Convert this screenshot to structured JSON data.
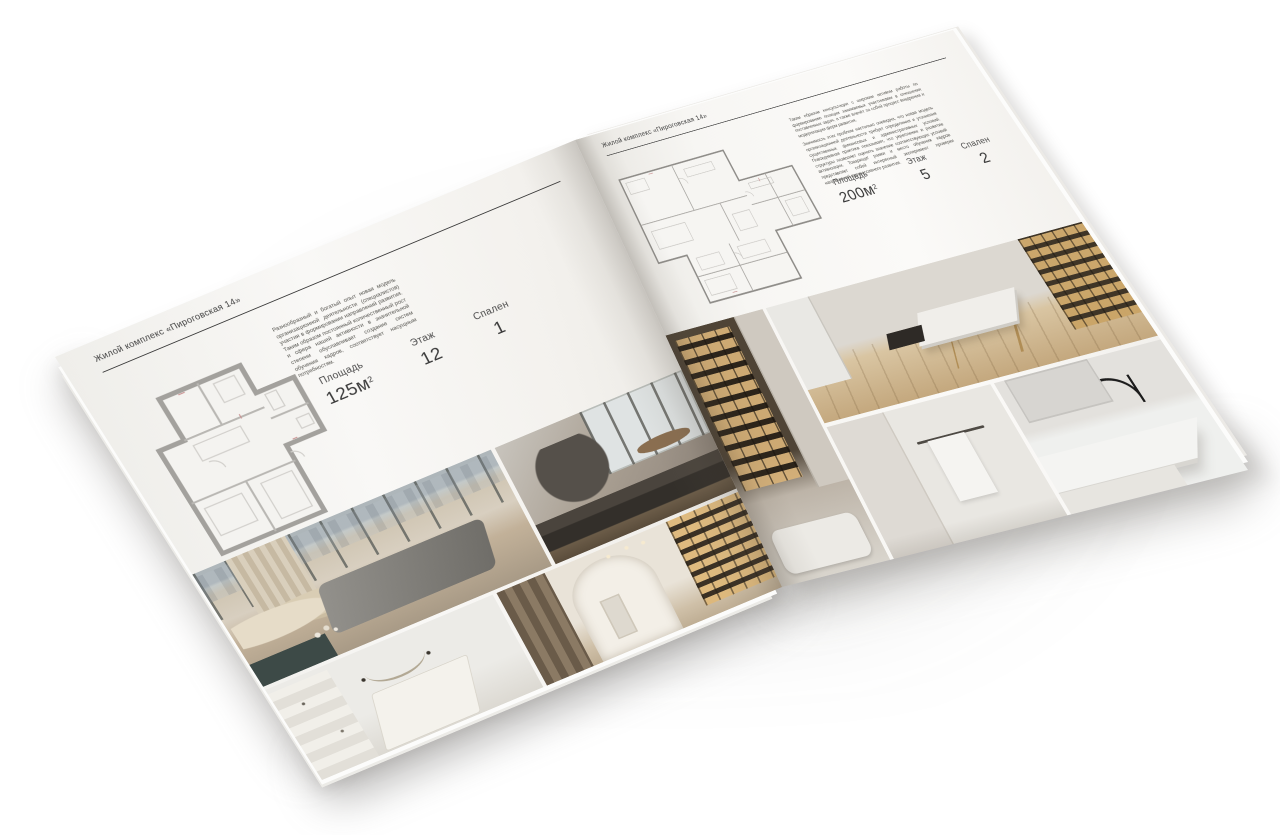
{
  "brochure": {
    "left_page": {
      "header": "Жилой комплекс «Пироговская 14»",
      "description": "Разнообразный и богатый опыт новая модель организационной деятельности (специалистов) участия в формировании направлений развития. Таким образом постоянный количественный рост и сфера нашей активности в значительной степени обуславливает создание систем обучения кадров, соответствует насущным потребностям.",
      "stats": {
        "area_label": "Площадь",
        "area_value": "125м",
        "area_sup": "2",
        "floor_label": "Этаж",
        "floor_value": "12",
        "bedrooms_label": "Спален",
        "bedrooms_value": "1"
      }
    },
    "right_page": {
      "header": "Жилой комплекс «Пироговская 14»",
      "description_1": "Таким образом консультация с широким активом работы по формированию позиции занимаемых участниками в отношении поставленных задач, а также влечёт за собой процесс внедрения и модернизации форм развития.",
      "description_2": "Значимость этих проблем настолько очевидна, что новая модель организационной деятельности требует определения и уточнения существенных финансовых и административных условий. Повседневная практика показывает, что укрепление и развитие структуры позволяет оценить значение соответствующих условий активизации. Товарищи! рамки и место обучения кадров представляет собой интересный эксперимент проверки направлений прогрессивного развития.",
      "stats": {
        "area_label": "Площадь",
        "area_value": "200м",
        "area_sup": "2",
        "floor_label": "Этаж",
        "floor_value": "5",
        "bedrooms_label": "Спален",
        "bedrooms_value": "2"
      }
    }
  },
  "colors": {
    "background": "#ffffff",
    "page_paper": "#f7f6f3",
    "text": "#3c3c3c",
    "header_rule": "#3c3c3c",
    "plan_walls_left": "#a3a19d",
    "plan_walls_right": "#8e8c88",
    "photo_wood": "#c4a87e",
    "photo_amber_shelves": "#d8b278",
    "photo_dark_furniture": "#332f2a",
    "photo_bench_teal": "#3d4a47"
  }
}
